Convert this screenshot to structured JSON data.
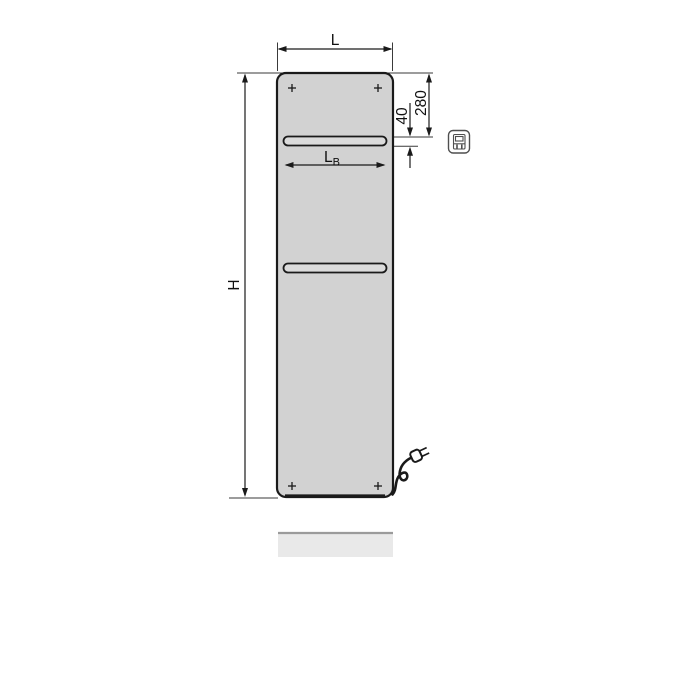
{
  "drawing": {
    "title": "panel-radiator-dimension-drawing",
    "labels": {
      "width": "L",
      "height": "H",
      "bar_width_main": "L",
      "bar_width_sub": "B",
      "top_to_bar": "280",
      "bar_thickness": "40"
    },
    "icon": {
      "name": "electric-connection-icon"
    },
    "colors": {
      "outline": "#1a1a1a",
      "thin_line": "#3a3a3a",
      "panel_fill": "#d2d2d2",
      "bar_fill": "#dbdbdb",
      "shadow_fill": "#e9e9e9",
      "shadow_edge": "#9b9b9b",
      "icon_stroke": "#4f4f4f",
      "text": "#111111",
      "background": "#ffffff"
    }
  }
}
